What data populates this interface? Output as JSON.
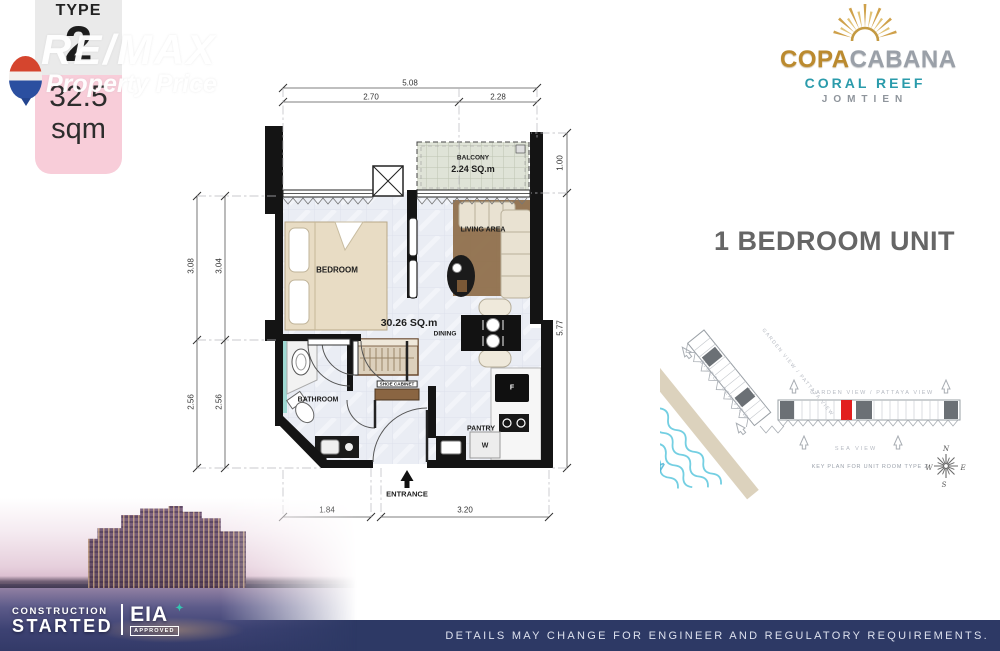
{
  "badge": {
    "type_label": "TYPE",
    "type_number": "2",
    "area_value": "32.5",
    "area_unit": "sqm"
  },
  "watermark": {
    "brand": "RE/MAX",
    "office": "Property Price"
  },
  "logo": {
    "name_part1": "COPA",
    "name_part2": "CABANA",
    "subtitle": "CORAL REEF",
    "location": "JOMTIEN"
  },
  "unit_title": "1 BEDROOM UNIT",
  "floorplan": {
    "area_label": "30.26 SQ.m",
    "rooms": {
      "balcony": "BALCONY",
      "balcony_area": "2.24 SQ.m",
      "bedroom": "BEDROOM",
      "living_area": "LIVING AREA",
      "dining": "DINING",
      "bathroom": "BATHROOM",
      "shoe_cabinet": "SHOE CABINET",
      "pantry": "PANTRY",
      "fridge_abbr": "F",
      "washer_abbr": "W",
      "entrance": "ENTRANCE"
    },
    "dimensions": {
      "top_total": "5.08",
      "top_left": "2.70",
      "top_right": "2.28",
      "left_outer_upper": "3.08",
      "left_inner_upper": "3.04",
      "left_outer_lower": "2.56",
      "left_inner_lower": "2.56",
      "right_upper": "1.00",
      "right_lower": "5.77",
      "bottom_left": "1.84",
      "bottom_right": "3.20"
    }
  },
  "keyplan": {
    "garden_view": "GARDEN VIEW / PATTAYA VIEW",
    "direct_sea_view": "DIRECT SEA VIEW",
    "sea": "SEA",
    "sea_view": "SEA VIEW",
    "caption": "KEY PLAN FOR UNIT ROOM TYPE 2",
    "compass": {
      "north": "N",
      "east": "E",
      "south": "S",
      "west": "W"
    }
  },
  "status": {
    "construction": "CONSTRUCTION",
    "started": "STARTED",
    "eia": "EIA",
    "eia_approved": "APPROVED"
  },
  "footer": {
    "disclaimer": "DETAILS MAY CHANGE FOR ENGINEER AND REGULATORY REQUIREMENTS."
  },
  "colors": {
    "accent_pink": "#f8cdd9",
    "gold": "#bb8a2e",
    "teal": "#2a9bab",
    "navy": "#2d3965",
    "unit_highlight_red": "#e21f1f"
  }
}
